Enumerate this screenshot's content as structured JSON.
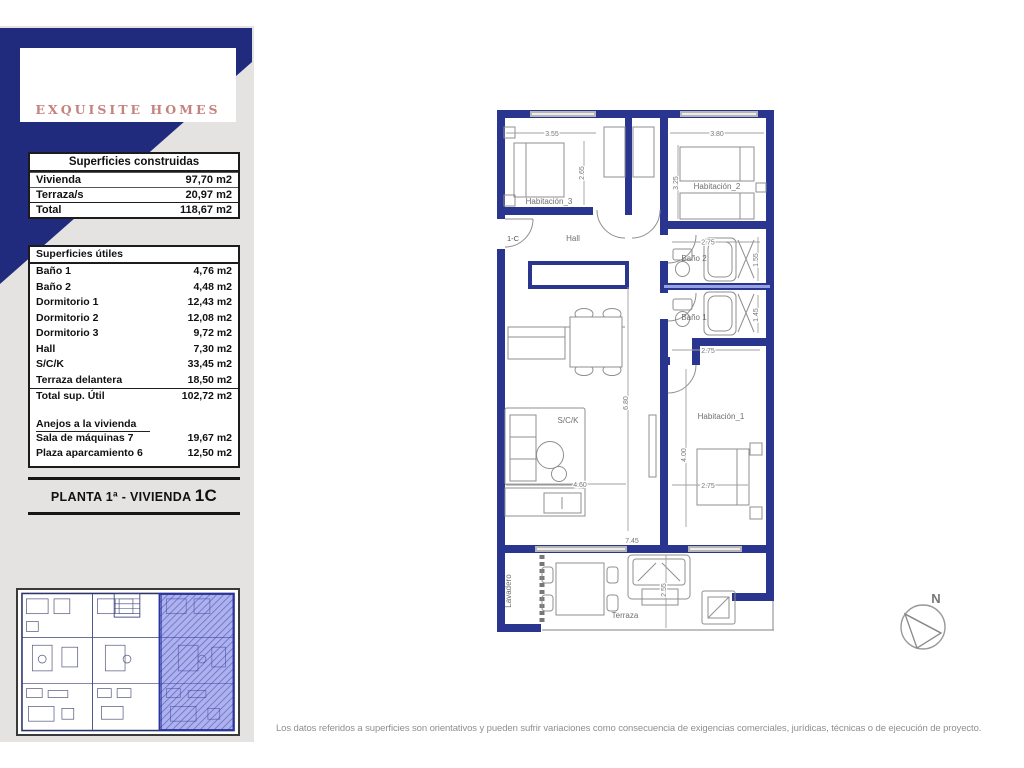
{
  "colors": {
    "navy": "#202b7d",
    "wall_navy": "#2a3590",
    "highlight_blue": "#5b63d6",
    "logo_text": "#c4837e",
    "sidebar_gray": "#e4e3e1"
  },
  "logo": {
    "brand": "EXQUISITE HOMES"
  },
  "built_table": {
    "title": "Superficies construidas",
    "rows": [
      {
        "label": "Vivienda",
        "value": "97,70 m2"
      },
      {
        "label": "Terraza/s",
        "value": "20,97 m2"
      },
      {
        "label": "Total",
        "value": "118,67 m2"
      }
    ]
  },
  "useful_table": {
    "title": "Superficies útiles",
    "rows": [
      {
        "label": "Baño 1",
        "value": "4,76 m2"
      },
      {
        "label": "Baño 2",
        "value": "4,48 m2"
      },
      {
        "label": "Dormitorio 1",
        "value": "12,43 m2"
      },
      {
        "label": "Dormitorio 2",
        "value": "12,08 m2"
      },
      {
        "label": "Dormitorio 3",
        "value": "9,72 m2"
      },
      {
        "label": "Hall",
        "value": "7,30 m2"
      },
      {
        "label": "S/C/K",
        "value": "33,45 m2"
      },
      {
        "label": "Terraza delantera",
        "value": "18,50 m2"
      },
      {
        "label": "Total sup. Útil",
        "value": "102,72 m2"
      }
    ]
  },
  "annex_table": {
    "title": "Anejos a la vivienda",
    "rows": [
      {
        "label": "Sala de máquinas  7",
        "value": "19,67 m2"
      },
      {
        "label": "Plaza aparcamiento  6",
        "value": "12,50 m2"
      }
    ]
  },
  "banner": {
    "prefix": "PLANTA 1ª - VIVIENDA ",
    "unit": "1C"
  },
  "plan": {
    "entrance_label": "1-C",
    "rooms": {
      "habitacion_3": "Habitación_3",
      "habitacion_2": "Habitación_2",
      "hall": "Hall",
      "bano_2": "Baño 2",
      "bano_1": "Baño 1",
      "sck": "S/C/K",
      "habitacion_1": "Habitación_1",
      "lavadero": "Lavadero",
      "terraza": "Terraza"
    },
    "dims": {
      "hab3_width": "3.55",
      "hab3_depth": "2.65",
      "hab2_width": "3.80",
      "hab2_depth": "3.25",
      "bano2_width": "2.75",
      "bano2_depth": "1.55",
      "bano1_width": "2.75",
      "bano1_depth": "1.45",
      "sck_length": "6.80",
      "sck_width": "4.60",
      "hab1_length": "4.00",
      "hab1_width": "2.75",
      "terraza_width": "7.45",
      "terraza_depth": "2.55"
    }
  },
  "compass": {
    "north_label": "N"
  },
  "disclaimer": "Los datos referidos a superficies son orientativos y pueden sufrir variaciones como consecuencia de exigencias comerciales, jurídicas, técnicas o de ejecución de proyecto."
}
